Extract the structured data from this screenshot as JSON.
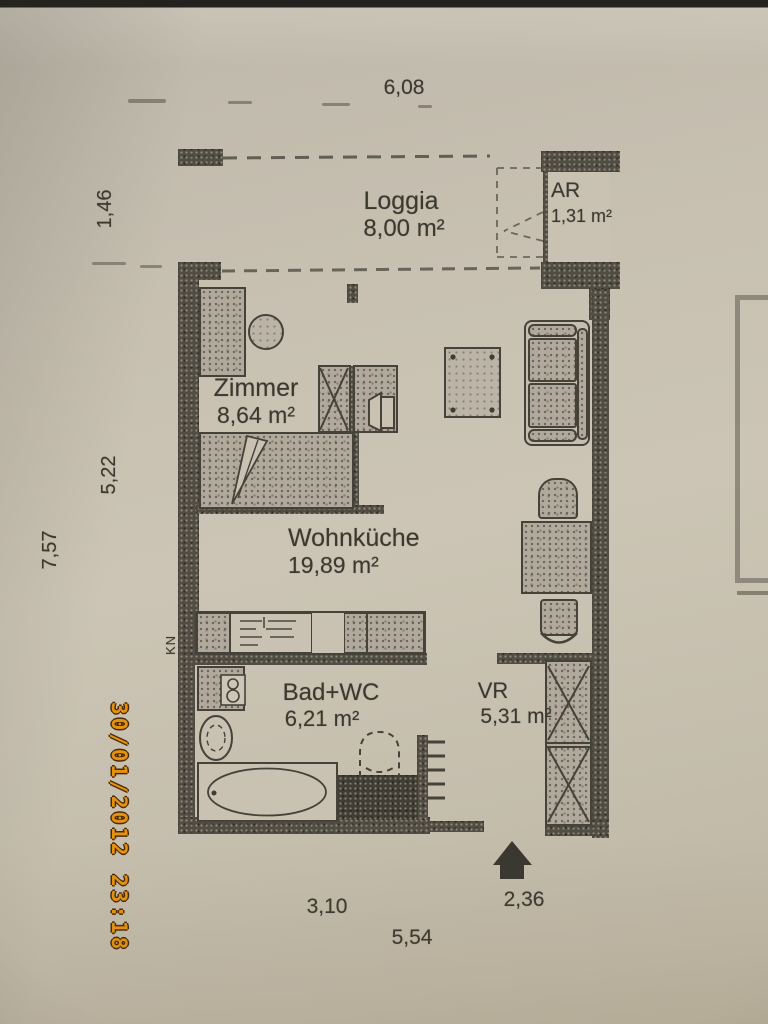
{
  "camera": {
    "timestamp": "30/01/2012 23:18"
  },
  "floorplan": {
    "rooms": [
      {
        "name": "Loggia",
        "area": "8,00 m²"
      },
      {
        "name": "AR",
        "area": "1,31 m²"
      },
      {
        "name": "Zimmer",
        "area": "8,64 m²"
      },
      {
        "name": "Wohnküche",
        "area": "19,89 m²"
      },
      {
        "name": "Bad+WC",
        "area": "6,21 m²"
      },
      {
        "name": "VR",
        "area": "5,31 m²"
      }
    ],
    "labels": {
      "kitchenette": "KN"
    },
    "dimensions": {
      "top_width": "6,08",
      "loggia_depth": "1,46",
      "main_depth": "5,22",
      "total_depth": "7,57",
      "bottom_left": "3,10",
      "bottom_entrance": "2,36",
      "bottom_total": "5,54"
    },
    "colors": {
      "paper": "#c6bfb0",
      "ink": "#3b382f",
      "wall": "#4a463c",
      "timestamp_orange": "#e6920e"
    }
  }
}
